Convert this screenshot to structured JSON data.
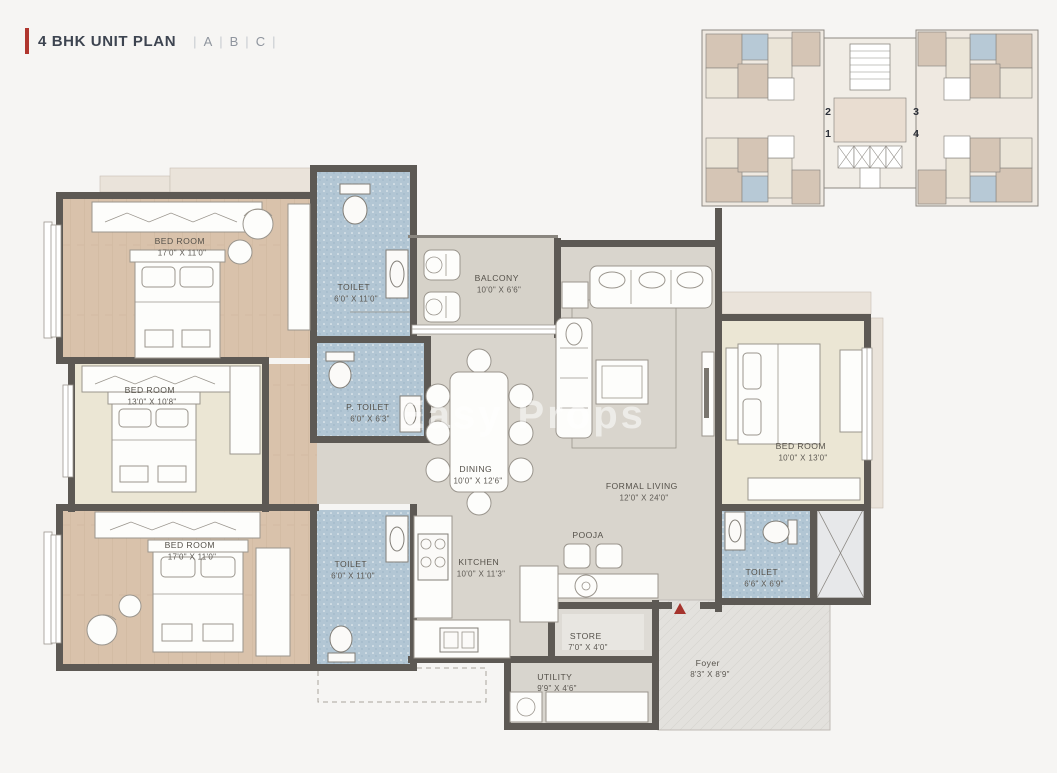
{
  "title": {
    "text": "4 BHK UNIT PLAN",
    "units": [
      "A",
      "B",
      "C"
    ],
    "accent_color": "#b0362e"
  },
  "key_plan": {
    "unit_numbers": {
      "u1": "1",
      "u2": "2",
      "u3": "3",
      "u4": "4"
    }
  },
  "watermark": {
    "text": "Easy Props"
  },
  "rooms": {
    "bedroom_top_left": {
      "name": "BED ROOM",
      "dim": "17'0\" X 11'0\""
    },
    "toilet_top": {
      "name": "TOILET",
      "dim": "6'0\" X 11'0\""
    },
    "p_toilet": {
      "name": "P. TOILET",
      "dim": "6'0\" X 6'3\""
    },
    "balcony": {
      "name": "BALCONY",
      "dim": "10'0\" X 6'6\""
    },
    "bedroom_mid_left": {
      "name": "BED ROOM",
      "dim": "13'0\" X 10'8\""
    },
    "bedroom_bottom_left": {
      "name": "BED ROOM",
      "dim": "17'0\" X 11'0\""
    },
    "toilet_bottom": {
      "name": "TOILET",
      "dim": "6'0\" X 11'0\""
    },
    "dining": {
      "name": "DINING",
      "dim": "10'0\" X 12'6\""
    },
    "formal_living": {
      "name": "FORMAL LIVING",
      "dim": "12'0\" X 24'0\""
    },
    "bedroom_right": {
      "name": "BED ROOM",
      "dim": "10'0\" X 13'0\""
    },
    "toilet_right": {
      "name": "TOILET",
      "dim": "6'6\" X 6'9\""
    },
    "kitchen": {
      "name": "KITCHEN",
      "dim": "10'0\" X 11'3\""
    },
    "pooja": {
      "name": "POOJA",
      "dim": ""
    },
    "store": {
      "name": "STORE",
      "dim": "7'0\" X 4'0\""
    },
    "utility": {
      "name": "UTILITY",
      "dim": "9'9\" X 4'6\""
    },
    "foyer": {
      "name": "Foyer",
      "dim": "8'3\" X 8'9\""
    }
  },
  "colors": {
    "wall": "#5d5954",
    "wood_floor": "#d9c2ab",
    "cream_floor": "#ebe6d4",
    "toilet_floor": "#b2c6d4",
    "living_floor": "#d9d5cd",
    "foyer_floor": "#e3e1dd",
    "entry_marker": "#a5332c"
  }
}
